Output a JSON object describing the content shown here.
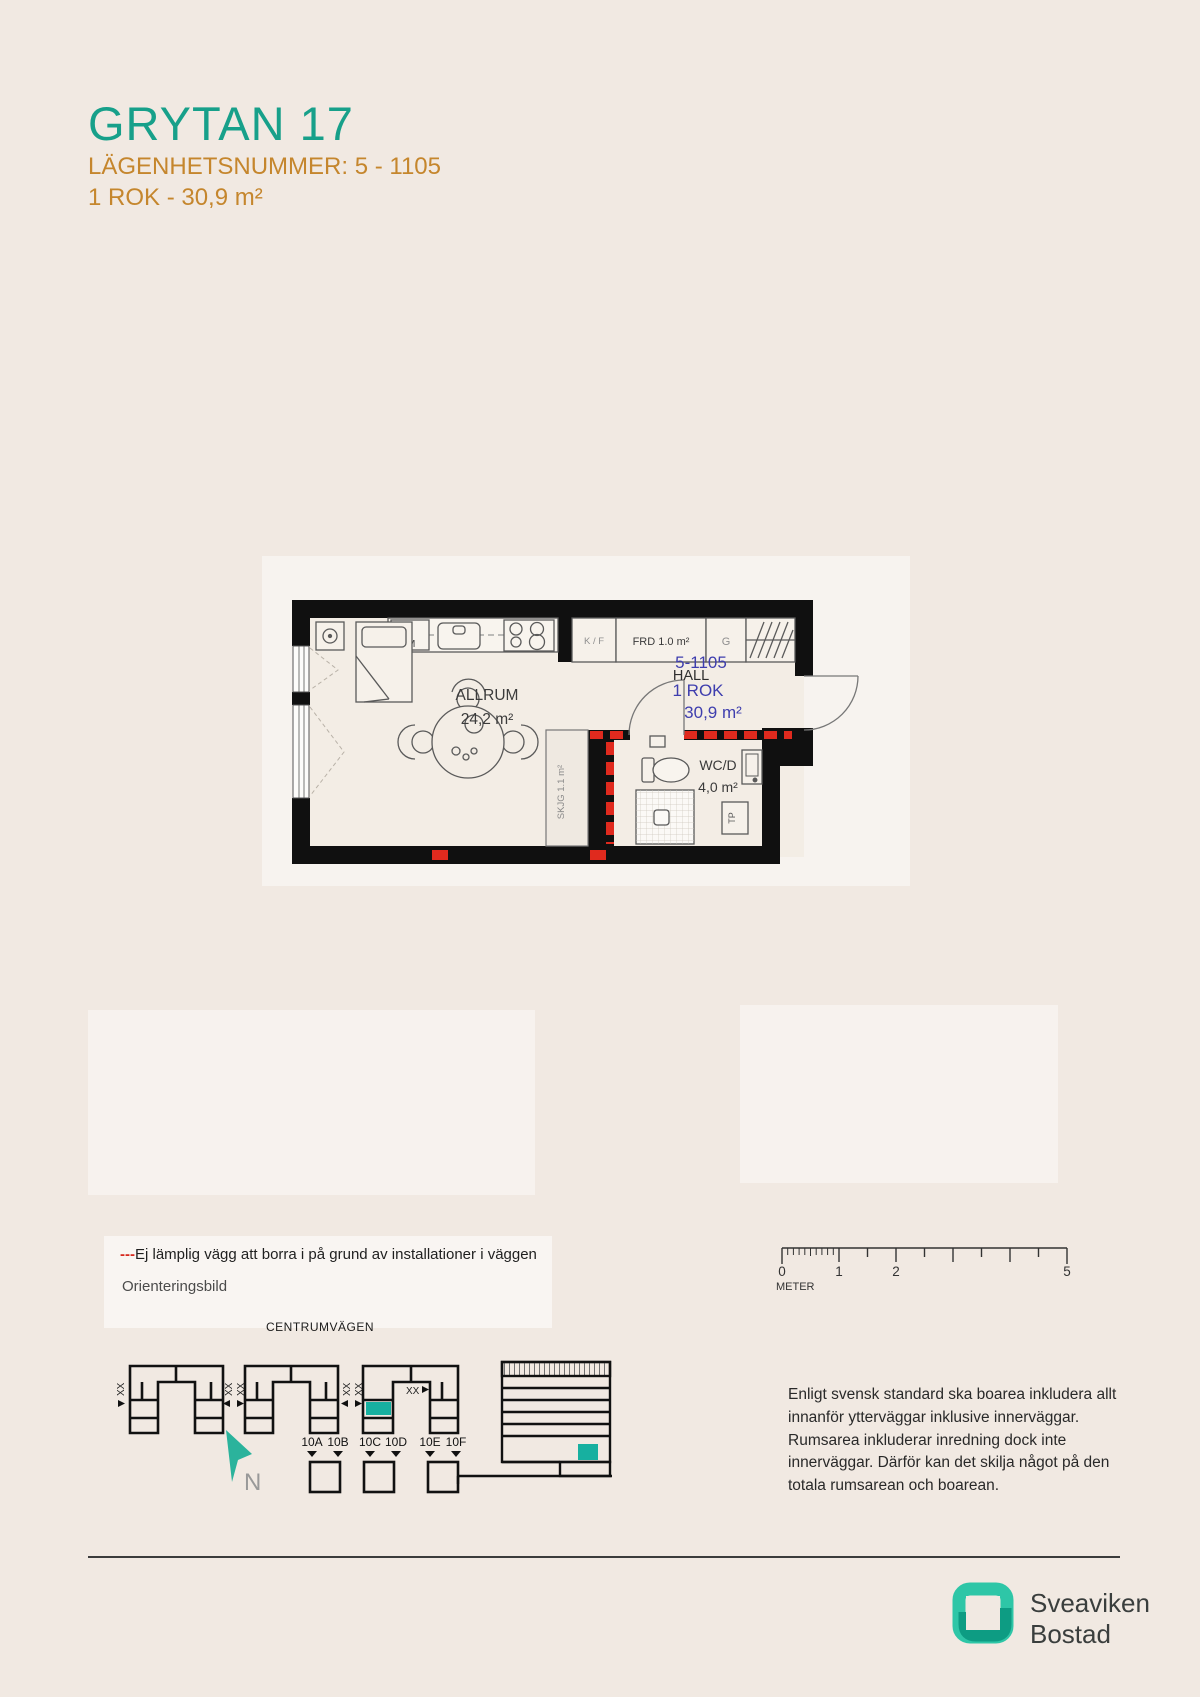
{
  "header": {
    "title": "GRYTAN 17",
    "apartment_number_line": "LÄGENHETSNUMMER: 5 - 1105",
    "size_line": "1 ROK - 30,9 m²",
    "title_color": "#17a08a",
    "subtitle_color": "#c5862d"
  },
  "floorplan": {
    "room_label": "ALLRUM",
    "room_area": "24,2 m²",
    "unit_number": "5-1105",
    "hall_label": "HALL",
    "unit_type": "1 ROK",
    "unit_area": "30,9 m²",
    "wc_label": "WC/D",
    "wc_area": "4,0 m²",
    "frd_label": "FRD 1.0 m²",
    "kf_label": "K / F",
    "g_label": "G",
    "dm_label": "DM",
    "skjg_label": "SKJG 1.1 m²",
    "tp_label": "TP",
    "accent_blue": "#3e3eae",
    "warning_red": "#e02a1e",
    "wall_black": "#101010"
  },
  "legend": {
    "dashes": "---",
    "warning_text": "Ej lämplig vägg att borra i på grund av installationer i väggen",
    "orientation_title": "Orienteringsbild"
  },
  "scalebar": {
    "tick_labels": [
      "0",
      "1",
      "2",
      "5"
    ],
    "unit": "METER"
  },
  "siteplan": {
    "street": "CENTRUMVÄGEN",
    "xx": "XX",
    "north": "N",
    "entrances": [
      "10A",
      "10B",
      "10C",
      "10D",
      "10E",
      "10F"
    ],
    "highlight_teal": "#17b0a0"
  },
  "description": {
    "text": "Enligt svensk standard ska boarea inkludera allt innanför ytterväggar inklusive innerväggar. Rumsarea inkluderar inredning dock inte innerväggar. Därför kan det skilja något på den totala rumsarean och boarean."
  },
  "footer": {
    "brand_line1": "Sveaviken",
    "brand_line2": "Bostad",
    "logo_teal_light": "#2ec6a7",
    "logo_teal_dark": "#0d9c83"
  }
}
